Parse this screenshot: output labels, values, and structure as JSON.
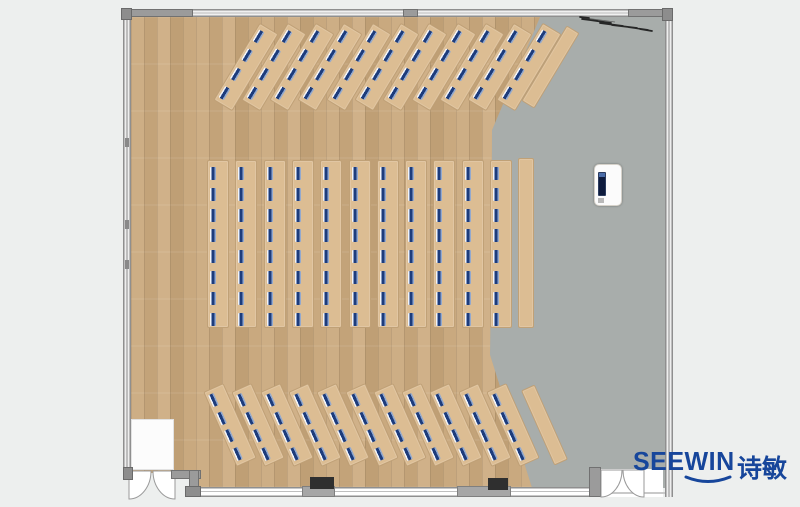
{
  "scene": {
    "type": "training-room-floor-plan",
    "render_style": "top-down 2D plan"
  },
  "palette": {
    "background": "#edefee",
    "floor_gray": "#a8adab",
    "floor_wood": "#c6a67c",
    "desk": "#dcbd93",
    "seat_marker": "#1d3c7c",
    "wall": "#8f8f8f",
    "logo_blue": "#17469b"
  },
  "logo": {
    "text": "SEEWIN",
    "cjk": "诗敏",
    "color": "#17469b"
  },
  "desk_layout": {
    "top": {
      "count": 11,
      "first_cx": 244.5,
      "spacing": 28.3,
      "cy": 65.5,
      "length": 88,
      "strip_width": 20,
      "angle": 31,
      "seats": 4,
      "seat_first": 5,
      "seat_spacing": 22
    },
    "middle": {
      "count": 11,
      "first_x": 207,
      "spacing": 28.3,
      "top": 160,
      "height": 166,
      "strip_width": 20,
      "angle": 0,
      "seats": 8,
      "seat_first": 6,
      "seat_spacing": 20.8
    },
    "bottom": {
      "count": 11,
      "first_cx": 229,
      "spacing": 28.3,
      "cy": 424,
      "length": 80,
      "strip_width": 20,
      "angle": -24,
      "seats": 4,
      "seat_first": 4,
      "seat_spacing": 19.5
    },
    "sideboards": [
      {
        "cx": 549,
        "cy": 66,
        "width": 13,
        "length": 86,
        "angle": 31
      },
      {
        "x": 518,
        "y": 158,
        "width": 14,
        "height": 168,
        "angle": 0
      },
      {
        "cx": 543,
        "cy": 424,
        "width": 13,
        "length": 80,
        "angle": -24
      }
    ],
    "total_seats": 176
  }
}
